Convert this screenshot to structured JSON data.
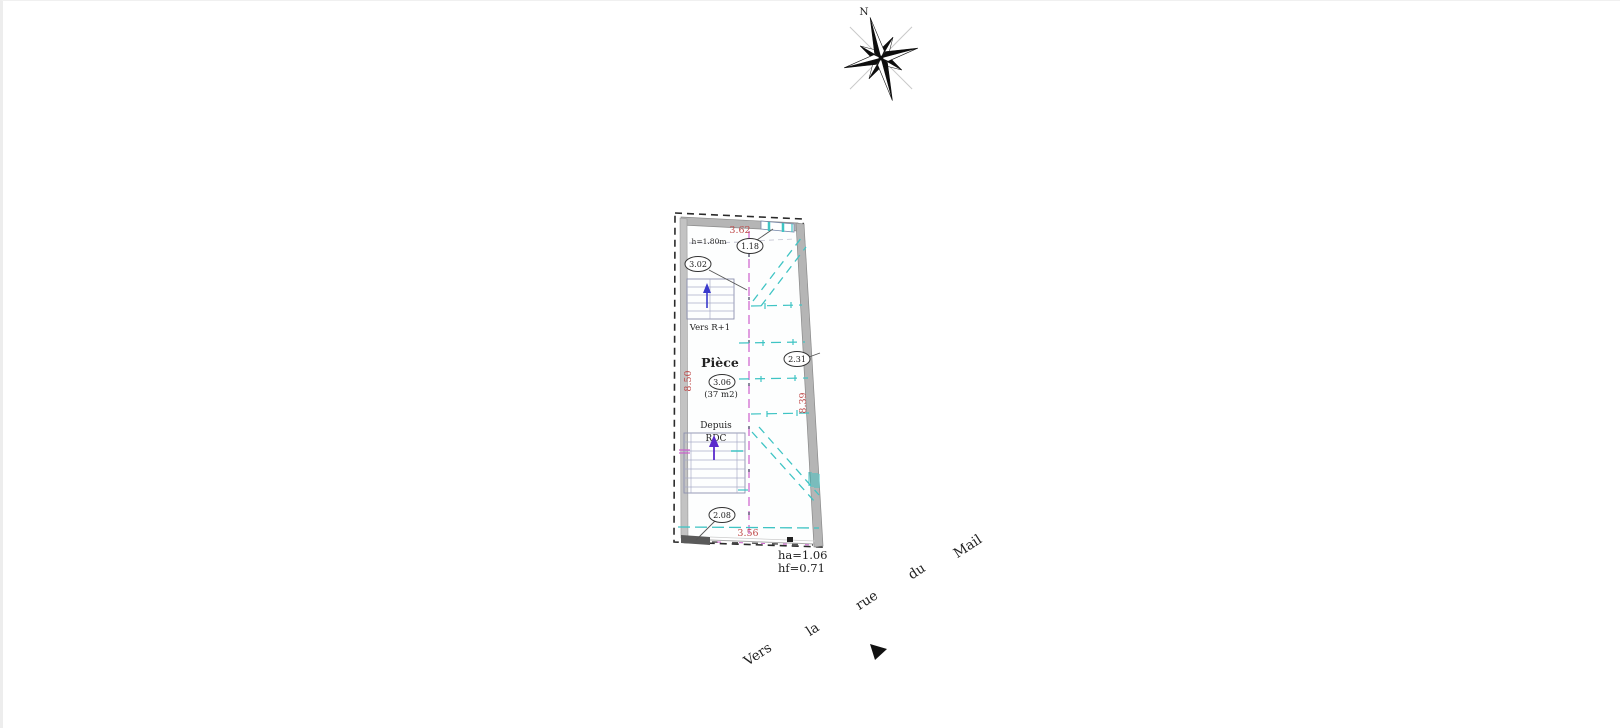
{
  "compass": {
    "north": "N"
  },
  "plan": {
    "room": {
      "name": "Pièce",
      "number": "3.06",
      "area": "(37 m2)"
    },
    "green_height_note": "h=1.80m",
    "dimensions": {
      "top": "3.62",
      "bottom": "3.56",
      "left": "8.50",
      "right": "8.39"
    },
    "height_bubbles": {
      "upper_left": "3.02",
      "upper_right": "1.18",
      "mid_right": "2.31",
      "lower": "2.08"
    },
    "stairs": {
      "up_label": "Vers R+1",
      "from_label_line1": "Depuis",
      "from_label_line2": "RDC"
    },
    "window_notes": {
      "ha": "ha=1.06",
      "hf": "hf=0.71"
    }
  },
  "street": {
    "words": [
      "Vers",
      "la",
      "rue",
      "du",
      "Mail"
    ]
  },
  "colors": {
    "dimension_red": "#bf4848",
    "teal": "#3fc4c4",
    "green": "#55b050",
    "ridge_magenta": "#cc5ecc",
    "wall_gray": "#b5b5b5",
    "stair_blue": "#3a3acc",
    "stair_purple": "#5a2acc"
  }
}
